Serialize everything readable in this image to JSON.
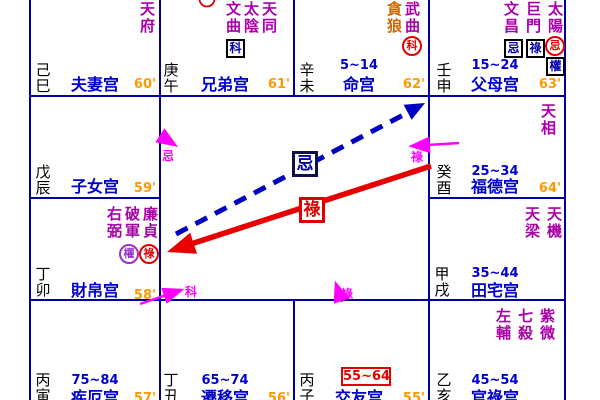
{
  "palette": {
    "grid": "#0000A0",
    "star_main": "#AA00AA",
    "star_dim": "#CC6600",
    "palace_name": "#0000CC",
    "age_range": "#0000CC",
    "minutes": "#FF9900",
    "stem_branch": "#000000",
    "transform_box_char": "#0000AA",
    "transform_red": "#E00000",
    "transform_purple": "#9933CC",
    "arrow_blue": "#0000C0",
    "arrow_red": "#E80000",
    "arrow_magenta": "#FF00FF"
  },
  "flying": {
    "ji": "忌",
    "lu": "祿",
    "self": [
      "忌",
      "科",
      "祿",
      "祿"
    ]
  },
  "cells": {
    "spouse": {
      "palace": "夫妻宫",
      "branch": "己巳",
      "minutes": "60'",
      "stars": [
        {
          "name": "天府"
        }
      ]
    },
    "sibling": {
      "palace": "兄弟宫",
      "branch": "庚午",
      "minutes": "61'",
      "stars": [
        {
          "name": "天同"
        },
        {
          "name": "太陰"
        },
        {
          "name": "文曲",
          "marks": [
            {
              "shape": "box",
              "char": "科"
            }
          ]
        }
      ]
    },
    "life": {
      "palace": "命宫",
      "branch": "辛未",
      "minutes": "62'",
      "age": "5~14",
      "stars": [
        {
          "name": "武曲",
          "marks": [
            {
              "shape": "red-circle",
              "char": "科"
            }
          ]
        },
        {
          "name": "貪狼"
        }
      ]
    },
    "parents": {
      "palace": "父母宫",
      "branch": "壬申",
      "minutes": "63'",
      "age": "15~24",
      "stars": [
        {
          "name": "太陽",
          "marks": [
            {
              "shape": "red-circle",
              "char": "忌"
            },
            {
              "shape": "box",
              "char": "權"
            }
          ]
        },
        {
          "name": "巨門",
          "marks": [
            {
              "shape": "box",
              "char": "祿"
            }
          ]
        },
        {
          "name": "文昌",
          "marks": [
            {
              "shape": "box",
              "char": "忌"
            }
          ]
        }
      ]
    },
    "children": {
      "palace": "子女宫",
      "branch": "戊辰",
      "minutes": "59'",
      "stars": []
    },
    "fortune": {
      "palace": "福德宫",
      "branch": "癸酉",
      "minutes": "64'",
      "age": "25~34",
      "stars": [
        {
          "name": "天相"
        }
      ]
    },
    "wealth": {
      "palace": "財帛宫",
      "branch": "丁卯",
      "minutes": "58'",
      "stars": [
        {
          "name": "廉貞",
          "marks": [
            {
              "shape": "red-circle",
              "char": "祿"
            }
          ]
        },
        {
          "name": "破軍",
          "marks": [
            {
              "shape": "purple-circle",
              "char": "權"
            }
          ]
        },
        {
          "name": "右弼"
        }
      ]
    },
    "property": {
      "palace": "田宅宫",
      "branch": "甲戌",
      "age": "35~44",
      "stars": [
        {
          "name": "天機"
        },
        {
          "name": "天梁"
        }
      ]
    },
    "health": {
      "palace": "疾厄宫",
      "branch": "丙寅",
      "minutes": "57'",
      "age": "75~84",
      "stars": []
    },
    "travel": {
      "palace": "遷移宫",
      "branch": "丁丑",
      "minutes": "56'",
      "age": "65~74",
      "stars": []
    },
    "friends": {
      "palace": "交友宫",
      "branch": "丙子",
      "minutes": "55'",
      "age": "55~64",
      "age_highlighted": true,
      "stars": []
    },
    "career": {
      "palace": "官祿宫",
      "branch": "乙亥",
      "age": "45~54",
      "stars": [
        {
          "name": "紫微"
        },
        {
          "name": "七殺"
        },
        {
          "name": "左輔"
        }
      ]
    }
  }
}
